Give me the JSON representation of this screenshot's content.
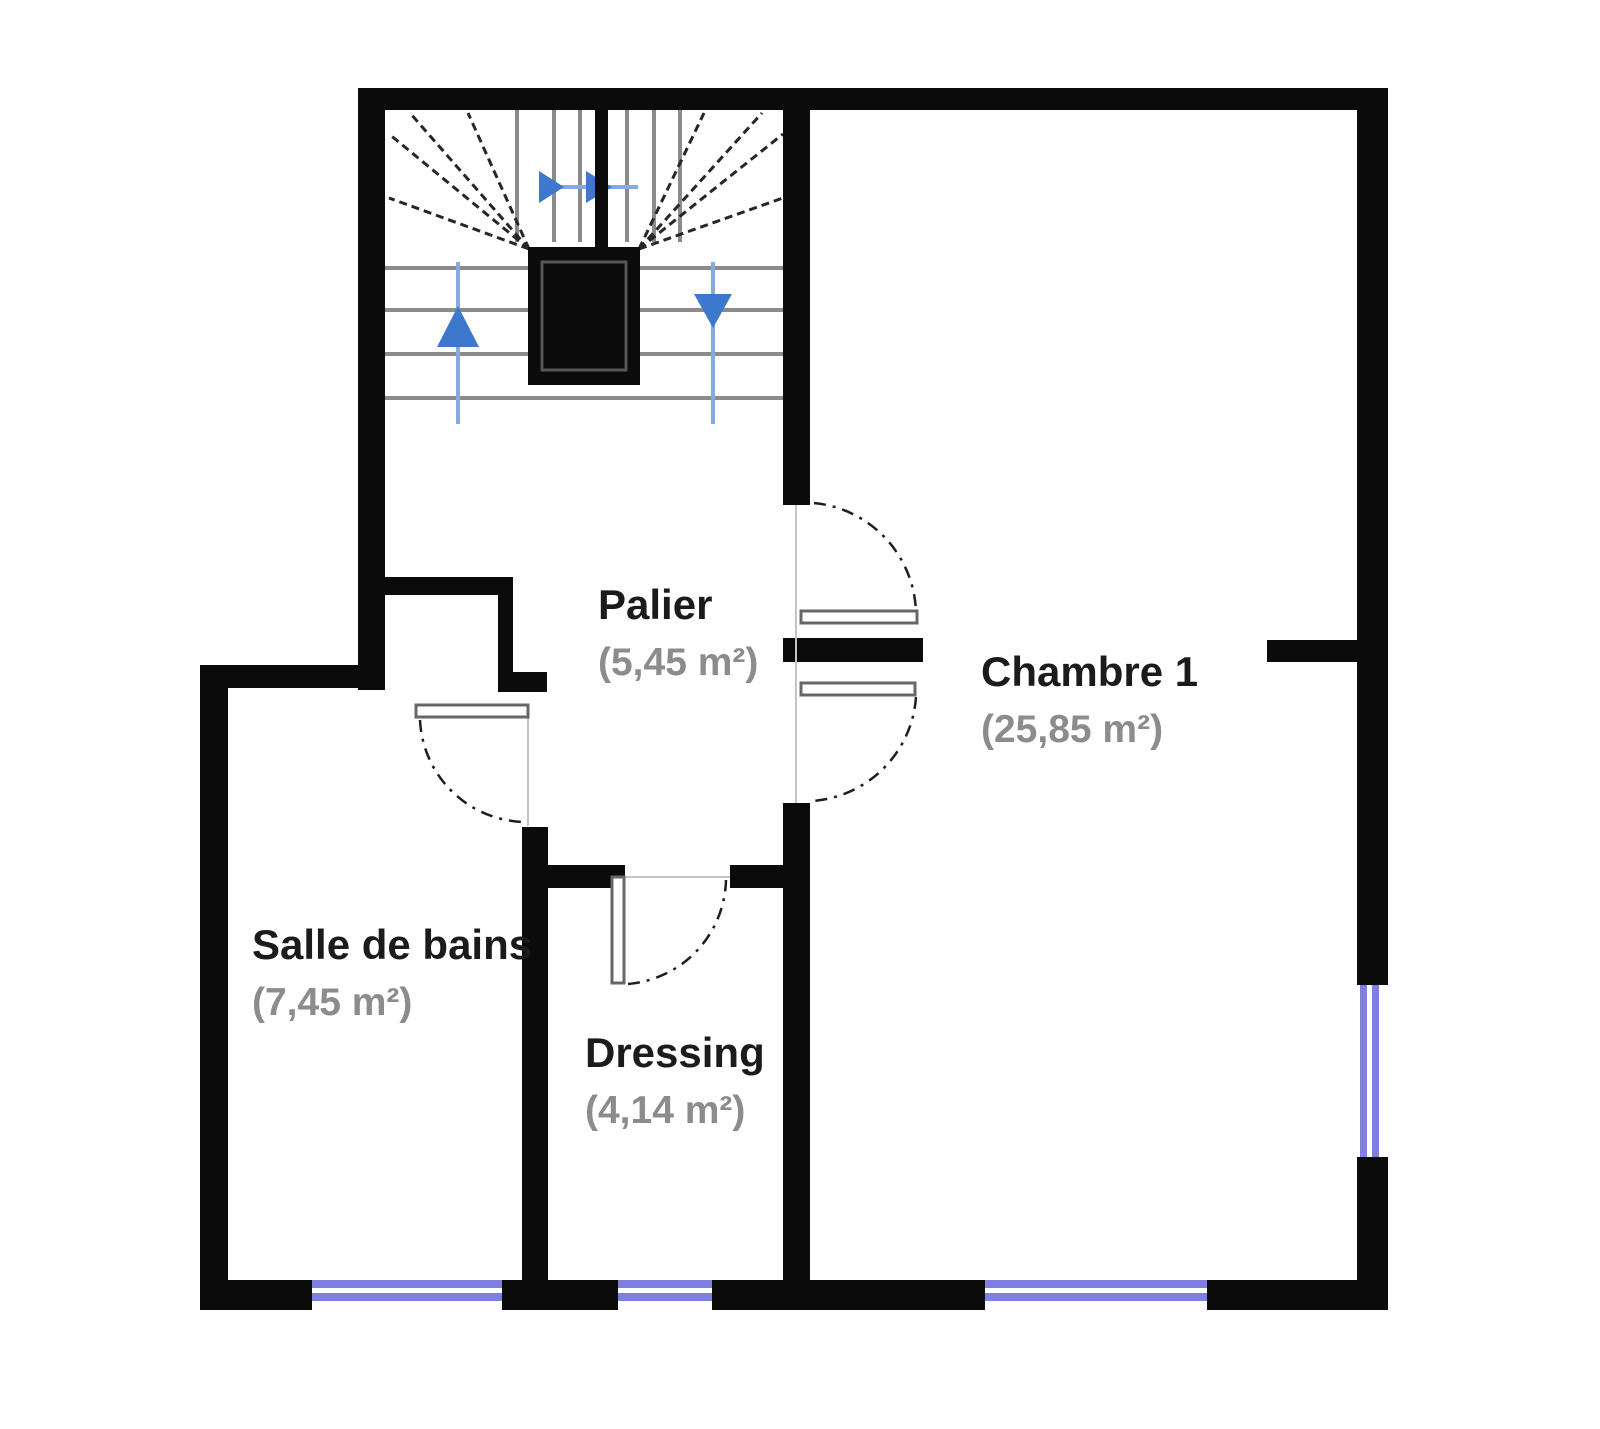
{
  "rooms": [
    {
      "name": "Palier",
      "area": "(5,45 m²)"
    },
    {
      "name": "Chambre 1",
      "area": "(25,85 m²)"
    },
    {
      "name": "Salle de bains",
      "area": "(7,45 m²)"
    },
    {
      "name": "Dressing",
      "area": "(4,14 m²)"
    }
  ],
  "icons": {
    "stair_up_arrow": "up-arrow",
    "stair_down_arrow": "down-arrow",
    "stair_direction_arrows": "right-arrows",
    "windows": "double-line-window",
    "doors": "quarter-circle-swing-door"
  },
  "colors": {
    "wall": "#0b0b0b",
    "tread": "#8b8b8b",
    "fan": "#262626",
    "window": "#7f7fe0",
    "arrow_line": "#85aae3",
    "arrow_head": "#3e78cc",
    "room_text": "#1b1b1b",
    "area_text": "#8c8c8c",
    "door_stroke": "#676767",
    "opening_line": "#c4c4c4",
    "arc": "#1e1e1e"
  }
}
